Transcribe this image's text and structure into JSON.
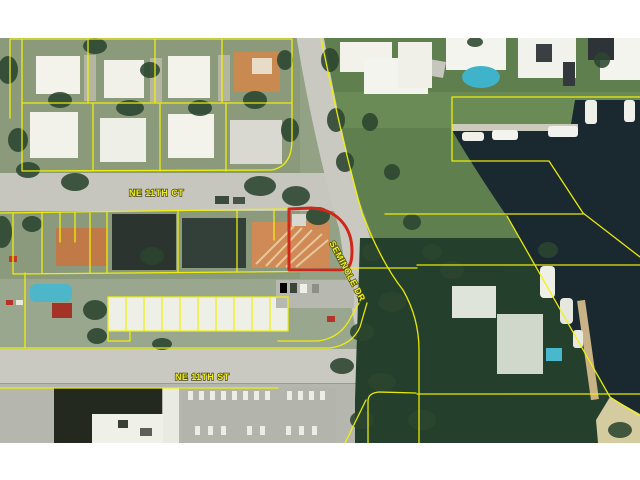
{
  "map": {
    "street_labels": {
      "ne_11th_ct": "NE 11TH CT",
      "seminole_dr": "SEMINOLE DR",
      "ne_11th_st": "NE 11TH ST"
    },
    "colors": {
      "parcel_line": "#f2f207",
      "subject_parcel": "#d02818",
      "street_label": "#f2ee20",
      "label_halo": "#4a4a12",
      "water": "#1a2830"
    }
  }
}
